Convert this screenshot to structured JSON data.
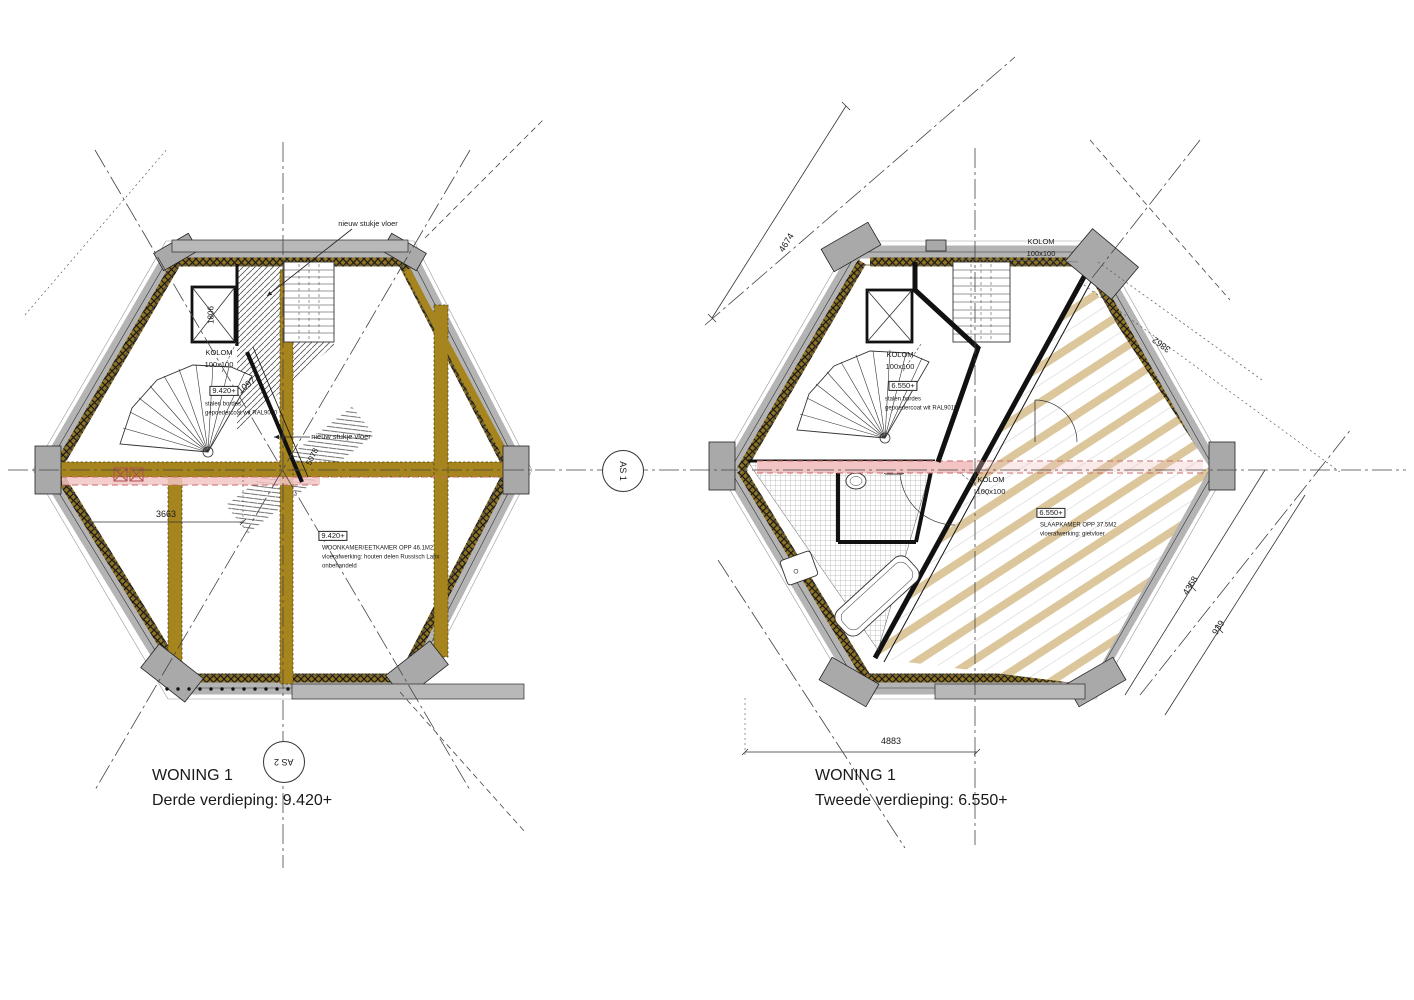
{
  "drawing": {
    "colors": {
      "beam_gold": "#a6851f",
      "wall_gray": "#b4b4b4",
      "joist_tan": "#dcc69b",
      "pink_band": "#f2c4c4",
      "dash_red": "#c96a6a",
      "line": "#333333"
    },
    "plans": [
      {
        "id": "plan-derde-verdieping",
        "title": "WONING 1",
        "subtitle": "Derde verdieping: 9.420+"
      },
      {
        "id": "plan-tweede-verdieping",
        "title": "WONING 1",
        "subtitle": "Tweede verdieping: 6.550+"
      }
    ],
    "axis_markers": [
      {
        "name": "axis-marker-as1",
        "label": "AS 1",
        "x": 622,
        "y": 470,
        "rot": 90
      },
      {
        "name": "axis-marker-as2",
        "label": "AS 2",
        "x": 283,
        "y": 761,
        "rot": 180
      }
    ],
    "annotations": [
      {
        "name": "label-nieuw-stukje-vloer-top",
        "text": "nieuw stukje vloer",
        "x": 368,
        "y": 224,
        "size": 7.5
      },
      {
        "name": "label-nieuw-stukje-vloer-mid",
        "text": "nieuw stukje vloer",
        "x": 341,
        "y": 437,
        "size": 7.5
      },
      {
        "name": "label-kolom-left",
        "text": "KOLOM",
        "x": 219,
        "y": 353,
        "size": 7.5
      },
      {
        "name": "label-kolom-left-size",
        "text": "100x100",
        "x": 219,
        "y": 365,
        "size": 7.5
      },
      {
        "name": "level-badge-bordes-left",
        "text": "9.420+",
        "x": 224,
        "y": 391,
        "size": 7.5,
        "boxed": true
      },
      {
        "name": "note-stalen-bordes-left",
        "text": "stalen bordes",
        "x": 205,
        "y": 405,
        "size": 6,
        "align": "left"
      },
      {
        "name": "note-ral-left",
        "text": "gepoedercoat wit RAL9010",
        "x": 205,
        "y": 414,
        "size": 6,
        "align": "left"
      },
      {
        "name": "dim-1097",
        "text": "1097",
        "x": 247,
        "y": 386,
        "size": 9,
        "rot": -38
      },
      {
        "name": "dim-5078",
        "text": "5078",
        "x": 313,
        "y": 457,
        "size": 8,
        "rot": -64
      },
      {
        "name": "level-badge-woonkamer",
        "text": "9.420+",
        "x": 333,
        "y": 536,
        "size": 7.5,
        "boxed": true
      },
      {
        "name": "note-woonkamer-opp",
        "text": "WOONKAMER/EETKAMER OPP 46.1M2",
        "x": 322,
        "y": 549,
        "size": 6,
        "align": "left"
      },
      {
        "name": "note-woonkamer-vloer",
        "text": "vloerafwerking: houten delen Russisch Larix",
        "x": 322,
        "y": 558,
        "size": 6,
        "align": "left"
      },
      {
        "name": "note-woonkamer-onbehandeld",
        "text": "onbehandeld",
        "x": 322,
        "y": 567,
        "size": 6,
        "align": "left"
      },
      {
        "name": "dim-3663",
        "text": "3663",
        "x": 166,
        "y": 515,
        "size": 9
      },
      {
        "name": "label-shaft-1806",
        "text": "1806",
        "x": 212,
        "y": 315,
        "size": 8,
        "rot": -90
      },
      {
        "name": "plan-left-title",
        "text": "WONING 1",
        "x": 152,
        "y": 776,
        "size": 16,
        "align": "left"
      },
      {
        "name": "plan-left-subtitle",
        "text": "Derde verdieping: 9.420+",
        "x": 152,
        "y": 801,
        "size": 16,
        "align": "left"
      },
      {
        "name": "label-kolom-top-right-plan",
        "text": "KOLOM",
        "x": 1041,
        "y": 242,
        "size": 7.5
      },
      {
        "name": "label-kolom-top-right-plan-size",
        "text": "100x100",
        "x": 1041,
        "y": 254,
        "size": 7.5
      },
      {
        "name": "label-kolom-mid-right-plan",
        "text": "KOLOM",
        "x": 900,
        "y": 355,
        "size": 7.5
      },
      {
        "name": "label-kolom-mid-right-plan-size",
        "text": "100x100",
        "x": 900,
        "y": 367,
        "size": 7.5
      },
      {
        "name": "level-badge-bordes-right",
        "text": "6.550+",
        "x": 903,
        "y": 386,
        "size": 7.5,
        "boxed": true
      },
      {
        "name": "note-stalen-bordes-right",
        "text": "stalen bordes",
        "x": 885,
        "y": 400,
        "size": 6,
        "align": "left"
      },
      {
        "name": "note-ral-right",
        "text": "gepoedercoat wit RAL9010",
        "x": 885,
        "y": 409,
        "size": 6,
        "align": "left"
      },
      {
        "name": "label-kolom-center-right-plan",
        "text": "KOLOM",
        "x": 991,
        "y": 480,
        "size": 7.5
      },
      {
        "name": "label-kolom-center-right-plan-size",
        "text": "100x100",
        "x": 991,
        "y": 492,
        "size": 7.5
      },
      {
        "name": "level-badge-slaapkamer",
        "text": "6.550+",
        "x": 1051,
        "y": 513,
        "size": 7.5,
        "boxed": true
      },
      {
        "name": "note-slaapkamer-opp",
        "text": "SLAAPKAMER OPP 37.5M2",
        "x": 1040,
        "y": 526,
        "size": 6,
        "align": "left"
      },
      {
        "name": "note-slaapkamer-vloer",
        "text": "vloerafwerking: gietvloer",
        "x": 1040,
        "y": 535,
        "size": 6,
        "align": "left"
      },
      {
        "name": "dim-4674",
        "text": "4674",
        "x": 787,
        "y": 243,
        "size": 9,
        "rot": -58
      },
      {
        "name": "dim-3862",
        "text": "3862",
        "x": 1162,
        "y": 344,
        "size": 9,
        "rot": 216
      },
      {
        "name": "dim-4368",
        "text": "4368",
        "x": 1191,
        "y": 586,
        "size": 9,
        "rot": -58
      },
      {
        "name": "dim-939",
        "text": "939",
        "x": 1219,
        "y": 628,
        "size": 9,
        "rot": -58
      },
      {
        "name": "dim-4883",
        "text": "4883",
        "x": 891,
        "y": 742,
        "size": 9
      },
      {
        "name": "plan-right-title",
        "text": "WONING 1",
        "x": 815,
        "y": 776,
        "size": 16,
        "align": "left"
      },
      {
        "name": "plan-right-subtitle",
        "text": "Tweede verdieping: 6.550+",
        "x": 815,
        "y": 801,
        "size": 16,
        "align": "left"
      }
    ]
  }
}
